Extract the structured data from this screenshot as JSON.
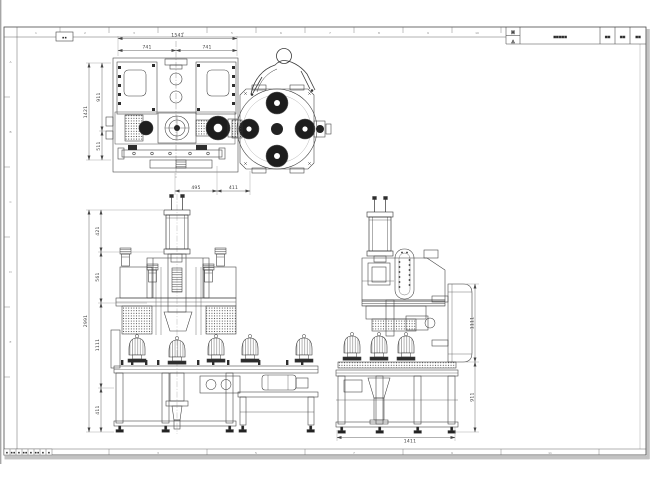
{
  "frame": {
    "corner_mark": "▪▪",
    "zone_top": [
      "1",
      "2",
      "3",
      "4",
      "5",
      "6",
      "7",
      "8",
      "9",
      "10",
      "11",
      "12"
    ],
    "zone_bottom": [
      "1",
      "2",
      "3",
      "4",
      "5",
      "6",
      "7",
      "8",
      "9",
      "10",
      "11",
      "12"
    ],
    "zone_left": [
      "A",
      "B",
      "C",
      "D",
      "E"
    ],
    "revision_cells": [
      "▪",
      "▪▪",
      "▪",
      "▪▪",
      "▪",
      "▪▪",
      "▪",
      "▪"
    ]
  },
  "title_block": {
    "projection_top": "M",
    "projection_bottom": "△",
    "drawing_name": "▪▪▪▪▪",
    "code": "▪▪",
    "scale": "▪▪",
    "sheet": "▪▪"
  },
  "dims": {
    "plan_total_w": "1541",
    "plan_half_left": "741",
    "plan_half_right": "741",
    "plan_total_h": "1421",
    "plan_upper_h": "911",
    "plan_lower_h": "511",
    "plan_foot_a": "495",
    "plan_foot_b": "411",
    "front_overall_h": "2991",
    "front_seg1": "421",
    "front_seg2": "561",
    "front_seg3": "1111",
    "front_seg4": "411",
    "side_upper_h": "1111",
    "side_lower_h": "911",
    "side_w": "1411"
  }
}
